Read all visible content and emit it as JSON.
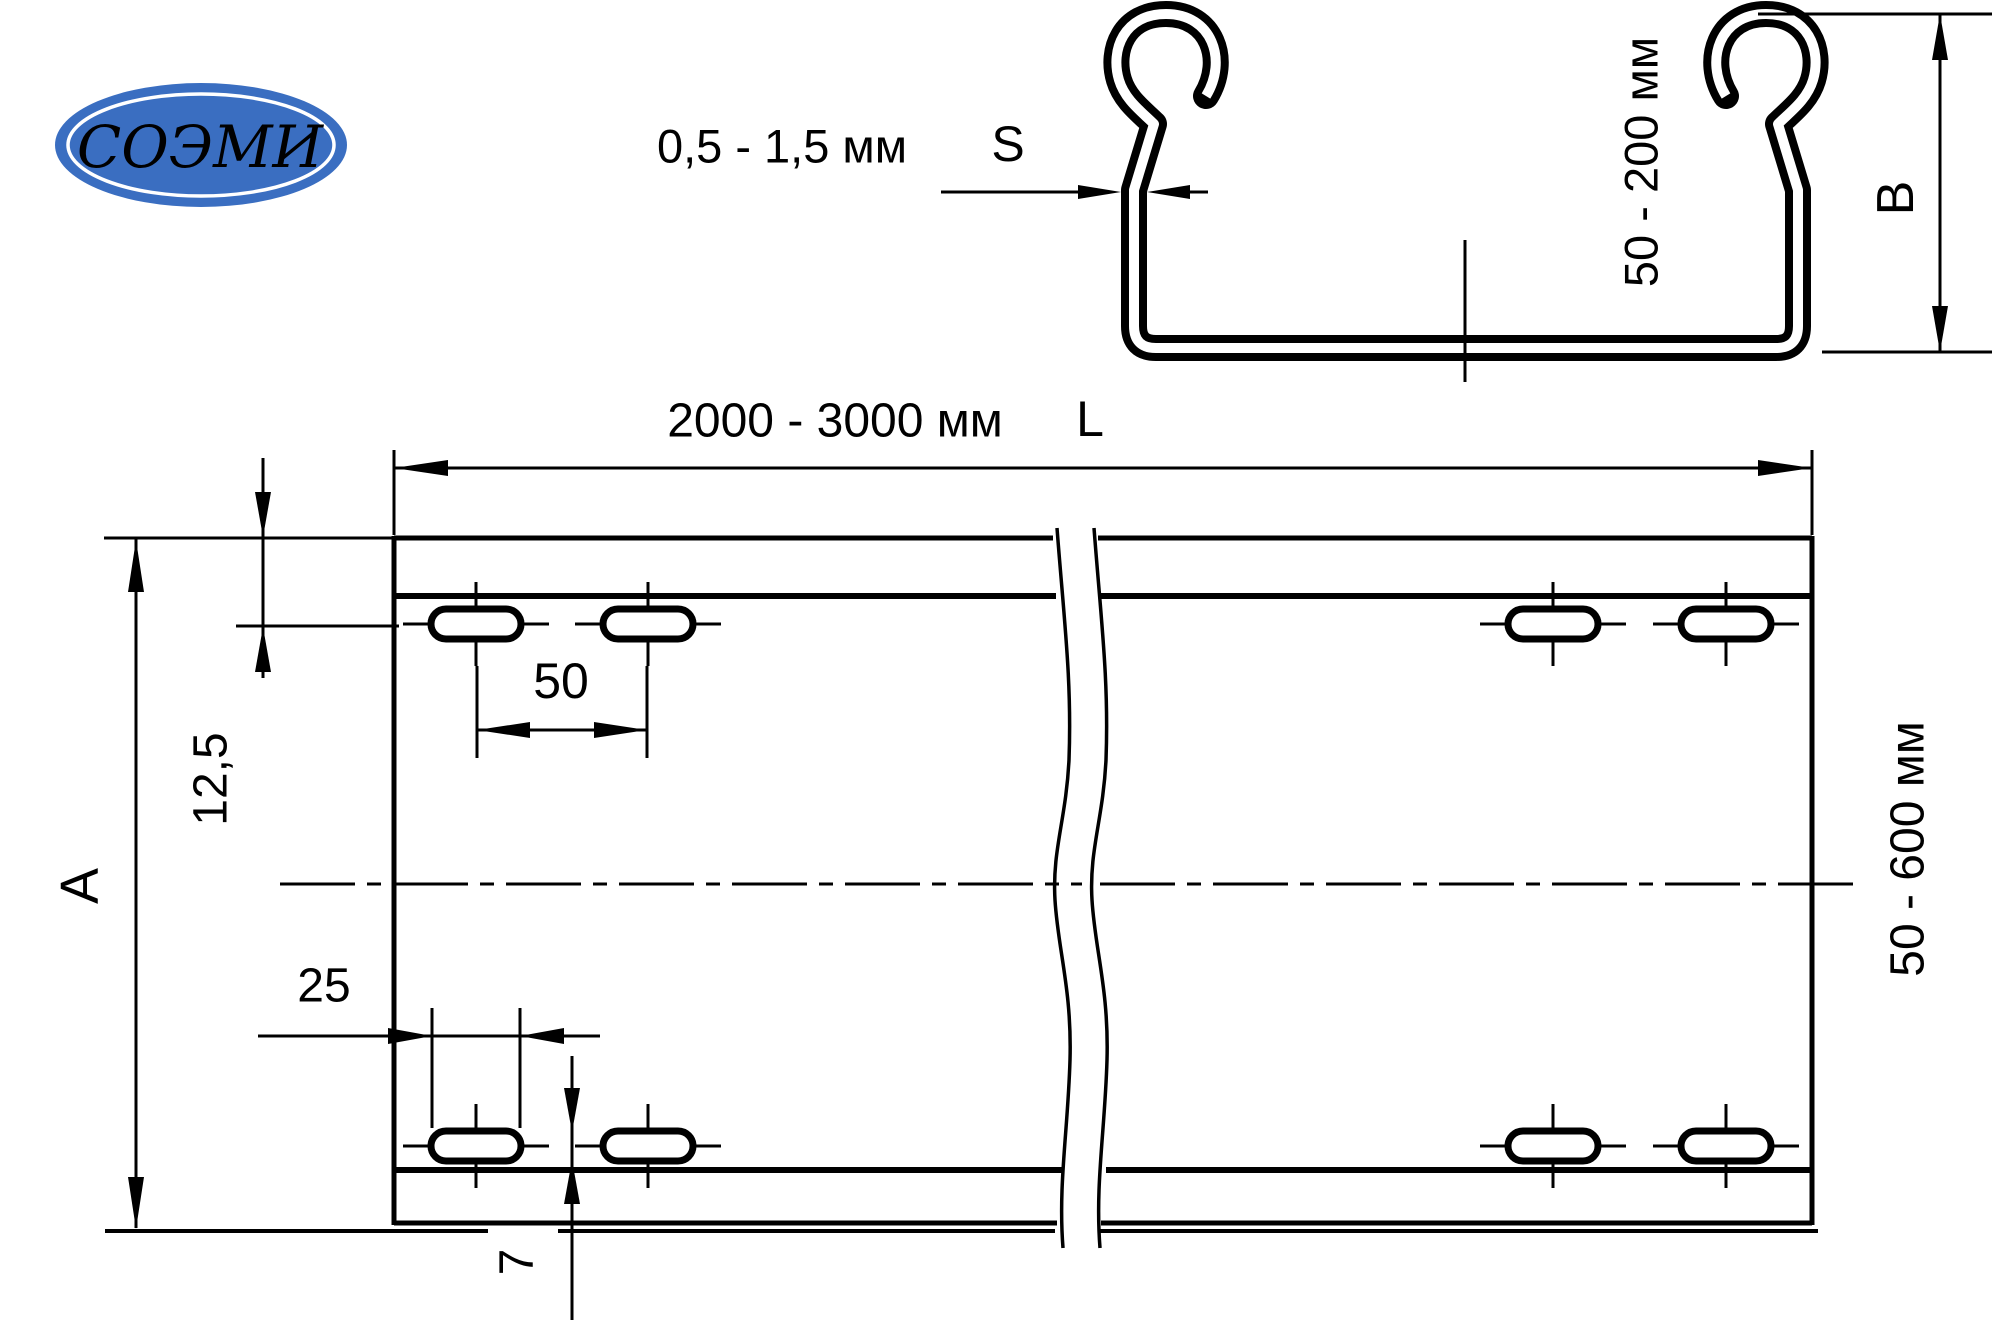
{
  "logo": {
    "text": "СОЭМИ",
    "bg_color": "#3a6ec1",
    "text_color": "#ffffff"
  },
  "profile_view": {
    "wall_thickness": {
      "range": "0,5 - 1,5 мм",
      "symbol": "S"
    },
    "height": {
      "range": "50 - 200 мм",
      "symbol": "B"
    }
  },
  "plan_view": {
    "length": {
      "range": "2000 - 3000 мм",
      "symbol": "L"
    },
    "width": {
      "range": "50 - 600 мм",
      "symbol": "A"
    },
    "slot_edge_offset": "12,5",
    "slot_pitch": "50",
    "slot_length": "25",
    "slot_width": "7"
  },
  "line_color": "#000000"
}
